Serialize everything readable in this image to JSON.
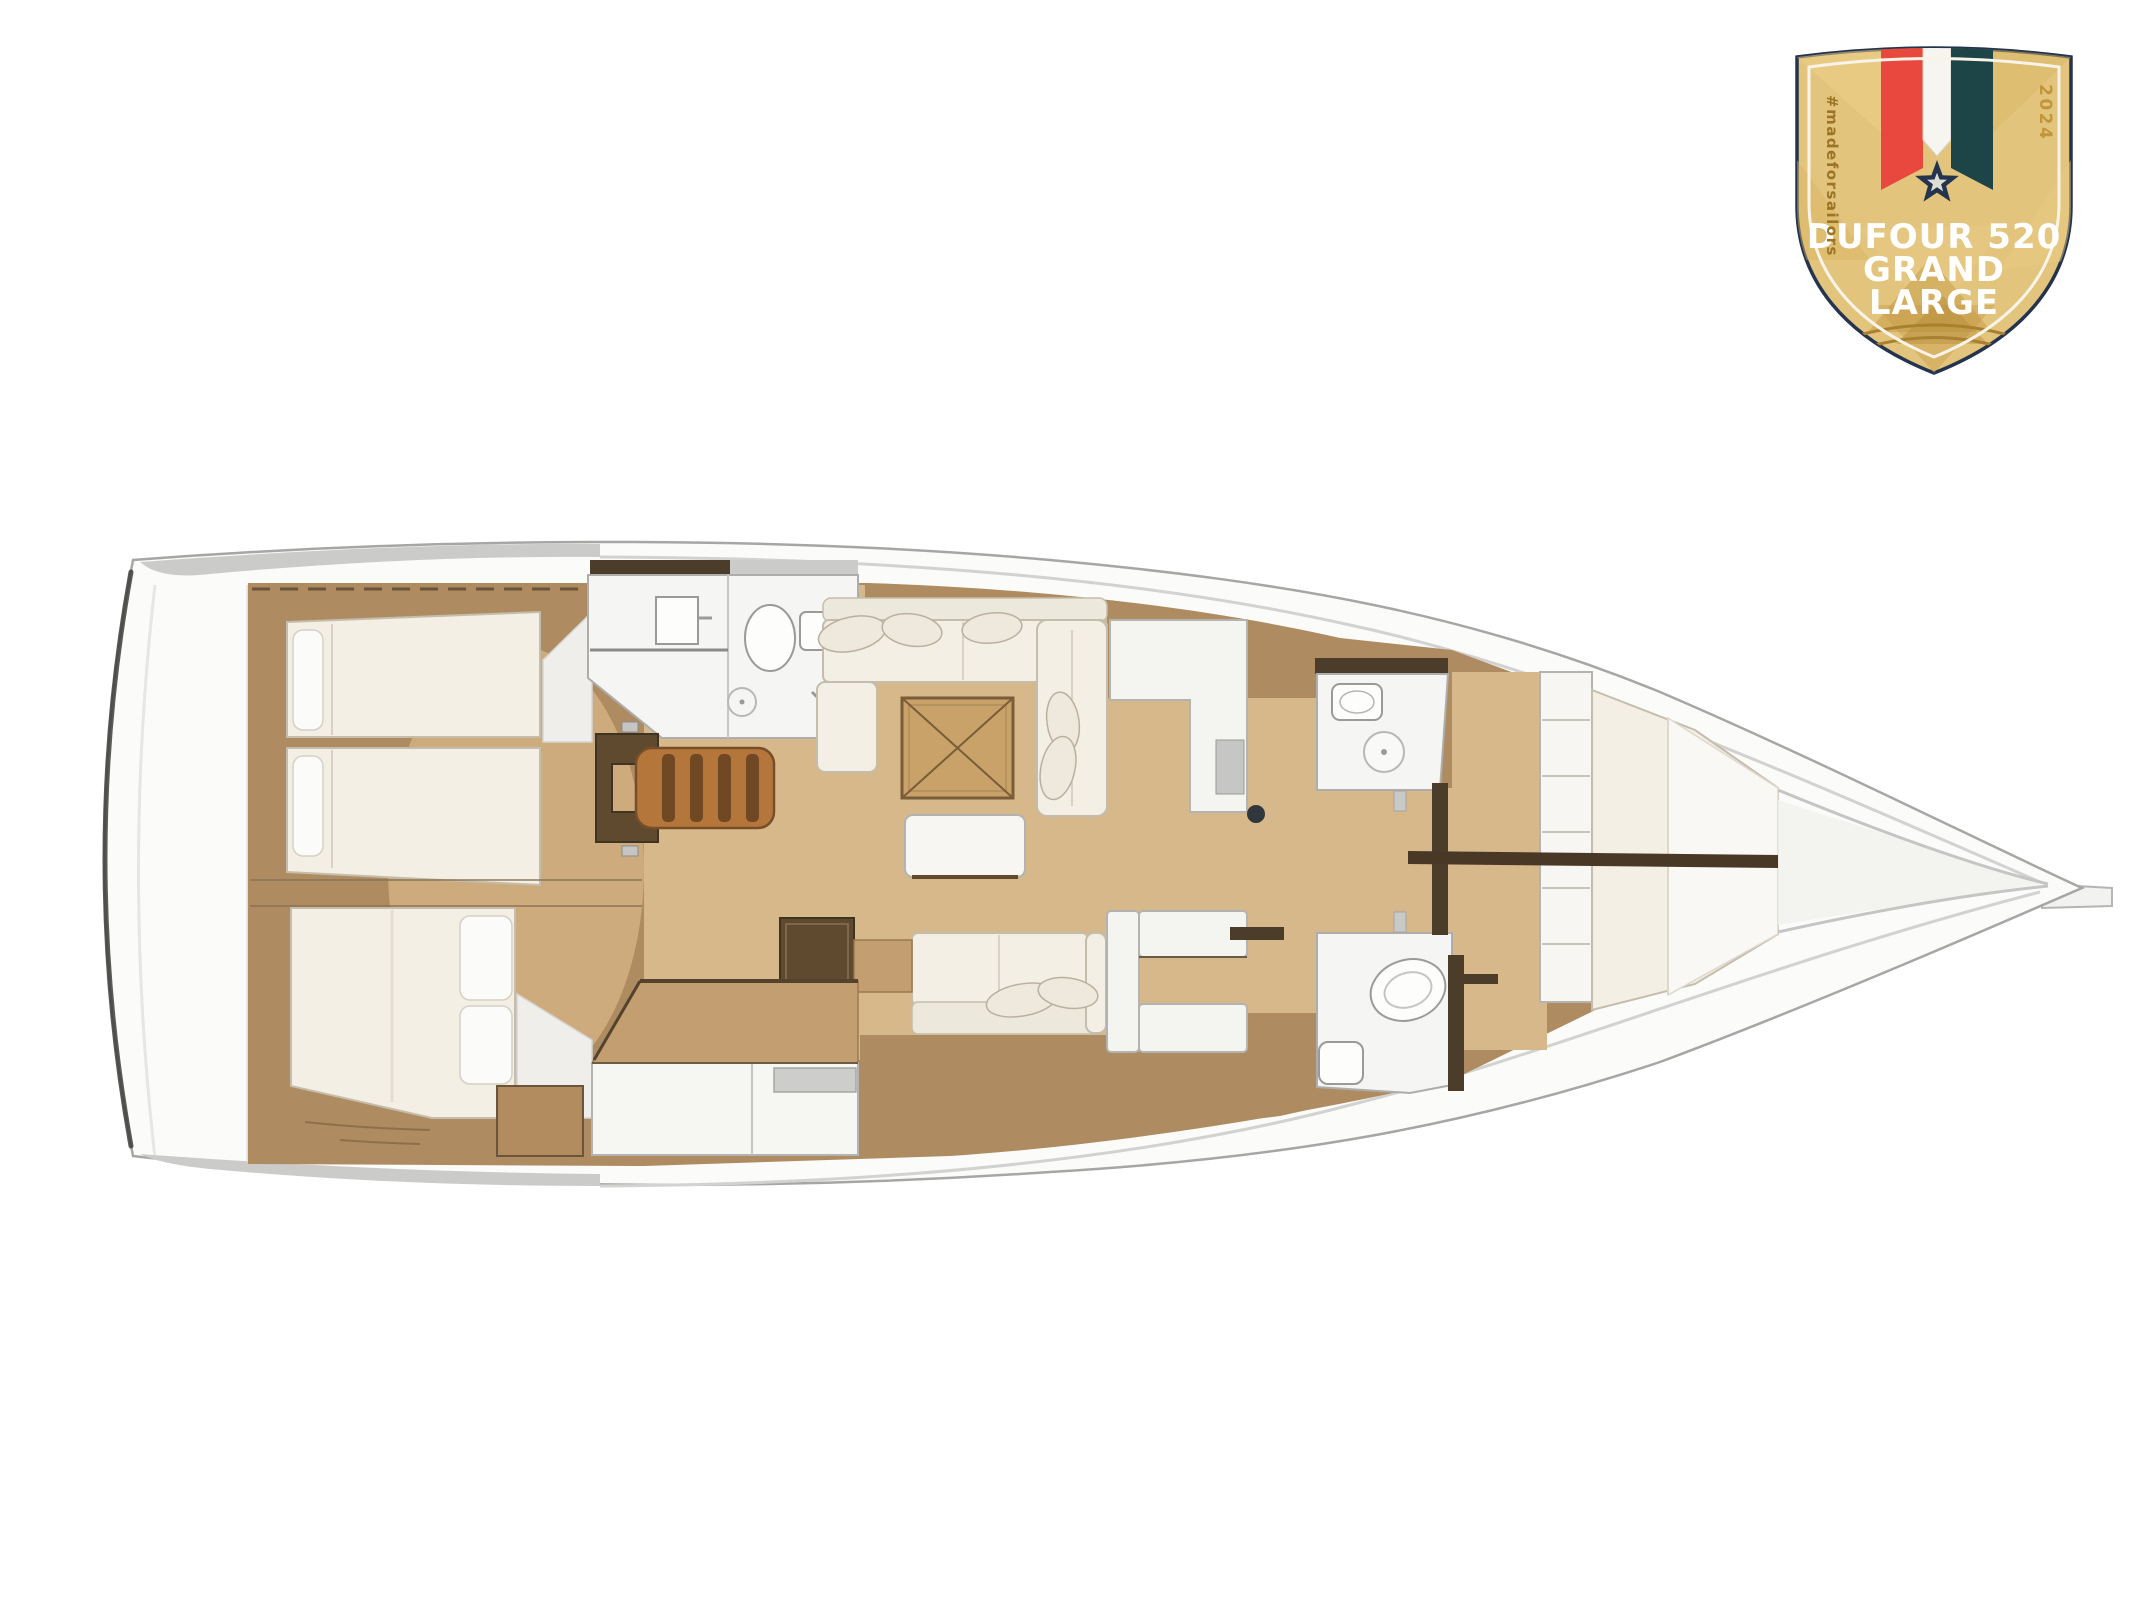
{
  "page": {
    "background": "#ffffff"
  },
  "badge": {
    "title_line1": "DUFOUR 520",
    "title_line2": "GRAND",
    "title_line3": "LARGE",
    "left_vertical_text": "#madeforsailors",
    "right_vertical_text": "2024",
    "colors": {
      "shield_gold": "#e3c47c",
      "border_navy": "#25344e",
      "ribbon_red": "#e8483d",
      "ribbon_white": "#f7f5ef",
      "ribbon_teal": "#1d4547",
      "star_navy": "#25344e",
      "title_white": "#ffffff",
      "side_text_gold": "#9c7427",
      "year_gold": "#c1963a"
    }
  },
  "floorplan": {
    "type": "yacht-interior-deck-plan",
    "model": "Dufour 520 Grand Large",
    "orientation": "bow-right",
    "colors": {
      "hull_white": "#fbfbf9",
      "hull_outline": "#a6a6a4",
      "deck_gray": "#cbcbc9",
      "wood_dark": "#ae8b60",
      "wood_light": "#d7b88a",
      "wood_mid": "#cdab7d",
      "table_wood": "#c9a269",
      "stairs_wood": "#b5763c",
      "partition_dark": "#4c3d2b",
      "upholstery_cream": "#f3efe4",
      "fixture_white": "#f5f5f3"
    },
    "rooms": [
      {
        "id": "transom",
        "label": "Stern platform"
      },
      {
        "id": "aft-cabin-port",
        "label": "Aft cabin with twin beds"
      },
      {
        "id": "aft-cabin-starboard",
        "label": "Aft cabin with double bed"
      },
      {
        "id": "aft-head",
        "label": "Aft head with sink, toilet and shower"
      },
      {
        "id": "companionway",
        "label": "Companionway steps"
      },
      {
        "id": "saloon",
        "label": "Saloon with U-sofa, folding table and bench"
      },
      {
        "id": "galley",
        "label": "Galley"
      },
      {
        "id": "nav-station",
        "label": "Chart table / nav station"
      },
      {
        "id": "wet-bar",
        "label": "Counter unit"
      },
      {
        "id": "mast",
        "label": "Mast position"
      },
      {
        "id": "fwd-head-shower",
        "label": "Forward shower room"
      },
      {
        "id": "fwd-head-toilet",
        "label": "Forward head"
      },
      {
        "id": "owner-cabin",
        "label": "Forward owner cabin with V-berth"
      },
      {
        "id": "bow",
        "label": "Bow"
      }
    ]
  }
}
